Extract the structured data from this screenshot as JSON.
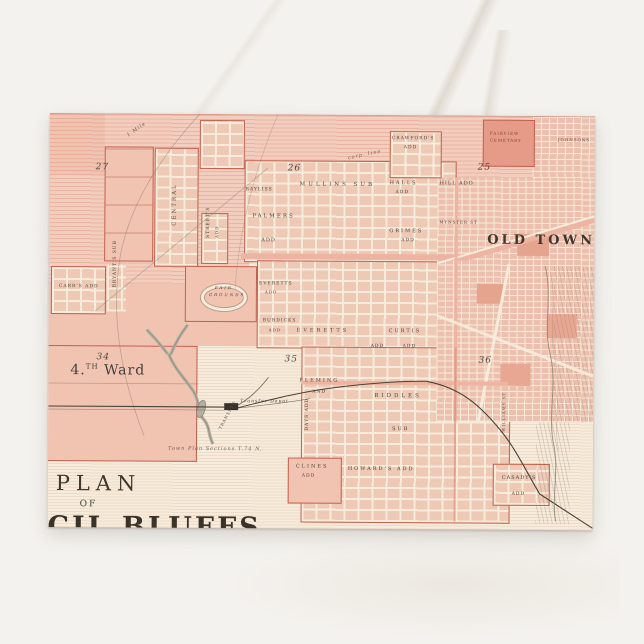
{
  "scene": {
    "surface": "white marble tabletop",
    "colors": {
      "background": "#f4f2ee",
      "vein": "#beb2a0"
    }
  },
  "postcard": {
    "kind": "vintage city-plan map postcard",
    "colors": {
      "paper": "#f7ecdb",
      "pink_light": "#f3cdbd",
      "pink": "#f1c3b1",
      "pink_dark": "#e69a88",
      "red_line": "#c4604f",
      "ink": "#4a4238"
    },
    "title": {
      "line1": "PLAN",
      "line2": "OF",
      "line3": "CIL BLUFFS"
    },
    "map": {
      "ward": {
        "num": "4.",
        "sup": "TH",
        "word": "Ward"
      },
      "sections": {
        "s27": "27",
        "s26": "26",
        "s25": "25",
        "s34": "34",
        "s35": "35",
        "s36": "36"
      },
      "landmarks": {
        "old_town": "OLD TOWN",
        "fair_grounds_1": "FAIR",
        "fair_grounds_2": "GROUNDS",
        "cemetery_1": "FAIRVIEW",
        "cemetery_2": "CEMETARY",
        "depot": "Transfer Depot",
        "transfer": "TRANSFER"
      },
      "districts": {
        "crawfords": "CRAWFORD'S",
        "crawfords2": "ADD",
        "johnsons": "JOHNSONS",
        "mullins": "MULLINS SUB",
        "bayliss": "BAYLISS",
        "halls": "HALLS",
        "halls2": "ADD",
        "hill": "HILL ADD",
        "palmers": "PALMERS",
        "palmers2": "ADD",
        "grimes": "GRIMES",
        "grimes2": "ADD",
        "everetts_a": "EVERETTS",
        "everetts_a2": "ADD",
        "everetts_b": "EVERETTS",
        "adds_b": "ADD",
        "curtis": "CURTIS",
        "adds_c": "ADD",
        "burdicks": "BURDICKS",
        "burdicks2": "ADD",
        "central": "CENTRAL",
        "streets_v": "STREET'S",
        "streets_v2": "ADD",
        "bryants": "BRYANT'S SUB",
        "carrs": "CARR'S ADD",
        "fleming": "FLEMING",
        "fleming2": "AND",
        "days": "DAYS ADD",
        "riddles": "RIDDLES",
        "riddles2": "SUB",
        "howards": "HOWARD'S ADD",
        "clines": "CLINES",
        "clines2": "ADD",
        "casadys": "CASADY'S",
        "casadys2": "ADD"
      },
      "streets": {
        "mynster": "MYNSTER ST",
        "williams": "WILLIAMS ST"
      },
      "notes": {
        "town_note": "Town Plan Sections T.74 N.",
        "mile": "1 Mile",
        "corp": "corp. line"
      }
    }
  }
}
